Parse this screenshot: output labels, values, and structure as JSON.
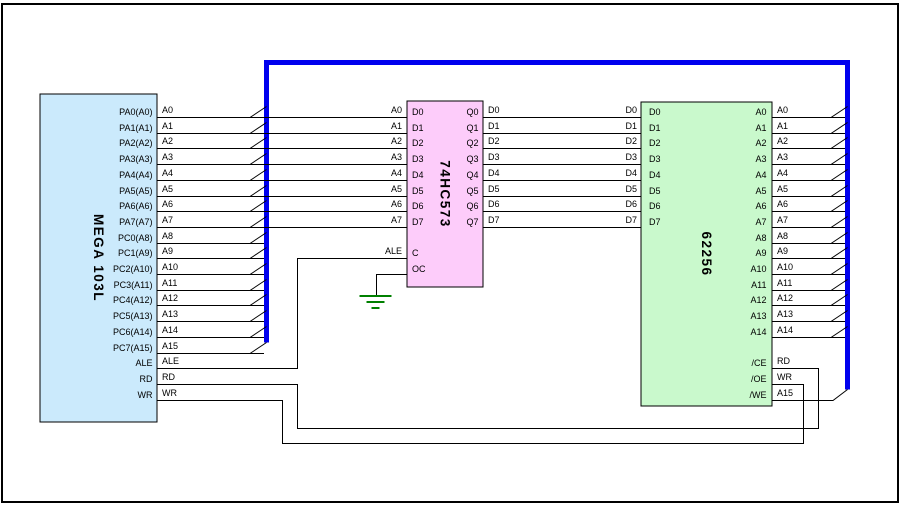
{
  "colors": {
    "background": "#ffffff",
    "border": "#000000",
    "wire": "#000000",
    "bus": "#0000ee",
    "ground": "#008000",
    "mega_fill": "#cbeafc",
    "latch_fill": "#fdccfa",
    "sram_fill": "#c9f9cc",
    "chip_stroke": "#000000"
  },
  "mega": {
    "title": "MEGA 103L",
    "pins": [
      "PA0(A0)",
      "PA1(A1)",
      "PA2(A2)",
      "PA3(A3)",
      "PA4(A4)",
      "PA5(A5)",
      "PA6(A6)",
      "PA7(A7)",
      "PC0(A8)",
      "PC1(A9)",
      "PC2(A10)",
      "PC3(A11)",
      "PC4(A12)",
      "PC5(A13)",
      "PC6(A14)",
      "PC7(A15)",
      "ALE",
      "RD",
      "WR"
    ]
  },
  "latch": {
    "title": "74HC573",
    "pins_left": [
      "D0",
      "D1",
      "D2",
      "D3",
      "D4",
      "D5",
      "D6",
      "D7",
      "C",
      "OC"
    ],
    "pins_right": [
      "Q0",
      "Q1",
      "Q2",
      "Q3",
      "Q4",
      "Q5",
      "Q6",
      "Q7"
    ]
  },
  "sram": {
    "title": "62256",
    "pins_left": [
      "D0",
      "D1",
      "D2",
      "D3",
      "D4",
      "D5",
      "D6",
      "D7"
    ],
    "pins_right": [
      "A0",
      "A1",
      "A2",
      "A3",
      "A4",
      "A5",
      "A6",
      "A7",
      "A8",
      "A9",
      "A10",
      "A11",
      "A12",
      "A13",
      "A14",
      "/CE",
      "/OE",
      "/WE"
    ]
  },
  "net_labels": {
    "mega_out": [
      "A0",
      "A1",
      "A2",
      "A3",
      "A4",
      "A5",
      "A6",
      "A7",
      "A8",
      "A9",
      "A10",
      "A11",
      "A12",
      "A13",
      "A14",
      "A15",
      "ALE",
      "RD",
      "WR"
    ],
    "latch_in": [
      "A0",
      "A1",
      "A2",
      "A3",
      "A4",
      "A5",
      "A6",
      "A7"
    ],
    "latch_clk": "ALE",
    "latch_out": [
      "D0",
      "D1",
      "D2",
      "D3",
      "D4",
      "D5",
      "D6",
      "D7"
    ],
    "sram_data": [
      "D0",
      "D1",
      "D2",
      "D3",
      "D4",
      "D5",
      "D6",
      "D7"
    ],
    "sram_addr": [
      "A0",
      "A1",
      "A2",
      "A3",
      "A4",
      "A5",
      "A6",
      "A7",
      "A8",
      "A9",
      "A10",
      "A11",
      "A12",
      "A13",
      "A14"
    ],
    "sram_ctrl": [
      "RD",
      "WR",
      "A15"
    ]
  }
}
